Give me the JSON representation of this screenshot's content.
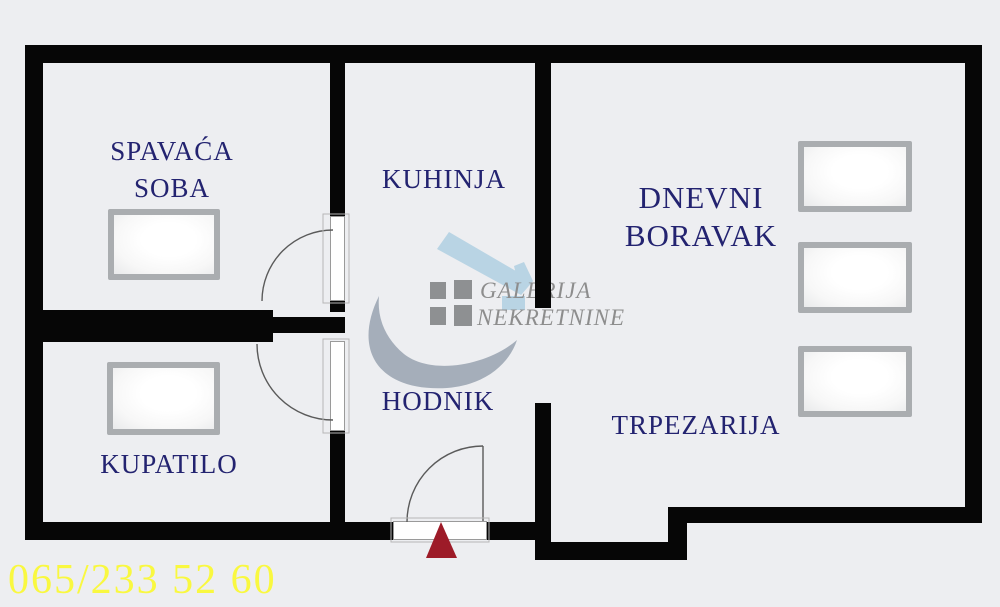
{
  "plan": {
    "rooms": {
      "spavaca": {
        "line1": "SPAVAĆA",
        "line2": "SOBA"
      },
      "kuhinja": {
        "line1": "KUHINJA"
      },
      "dnevni": {
        "line1": "DNEVNI",
        "line2": "BORAVAK"
      },
      "hodnik": {
        "line1": "HODNIK"
      },
      "kupatilo": {
        "line1": "KUPATILO"
      },
      "trpezarija": {
        "line1": "TRPEZARIJA"
      }
    }
  },
  "watermark": {
    "line1": "GALERIJA",
    "line2": "NEKRETNINE"
  },
  "contact": {
    "phone": "065/233 52 60"
  },
  "colors": {
    "background": "#edeef1",
    "wall": "#060606",
    "room_label": "#232370",
    "phone_yellow": "#f9f840",
    "entrance_marker_red": "#9d1b28",
    "watermark_text_gray": "#8d8d8d",
    "watermark_roof_blue": "#b9d4e4",
    "watermark_swoosh_gray": "#a5aeba",
    "watermark_squares_gray": "#8e9092",
    "door_line_gray": "#5a5a5a",
    "window_frame_gray": "#aaadb0"
  }
}
